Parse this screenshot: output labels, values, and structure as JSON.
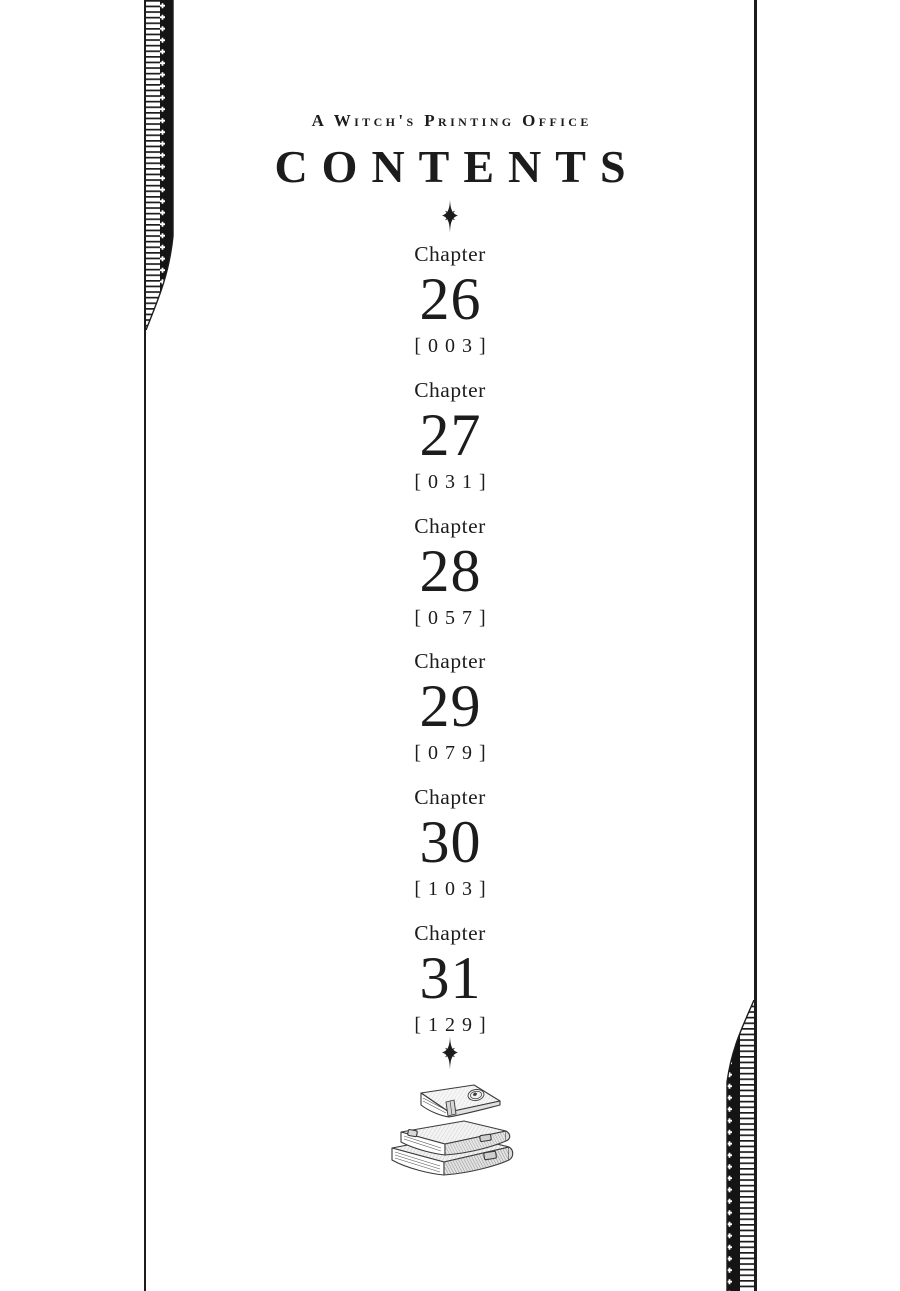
{
  "page": {
    "series_title": "A Witch's Printing Office",
    "title": "CONTENTS"
  },
  "chapters": [
    {
      "label": "Chapter",
      "number": "26",
      "page_display": "[003]"
    },
    {
      "label": "Chapter",
      "number": "27",
      "page_display": "[031]"
    },
    {
      "label": "Chapter",
      "number": "28",
      "page_display": "[057]"
    },
    {
      "label": "Chapter",
      "number": "29",
      "page_display": "[079]"
    },
    {
      "label": "Chapter",
      "number": "30",
      "page_display": "[103]"
    },
    {
      "label": "Chapter",
      "number": "31",
      "page_display": "[129]"
    }
  ],
  "icons": {
    "sparkle_top": "four-point-sparkle",
    "sparkle_bottom": "four-point-sparkle",
    "books": "stacked-antique-books",
    "left_border": "filmstrip-ladder-ornament",
    "right_border": "filmstrip-ladder-ornament"
  },
  "colors": {
    "ink": "#1c1c1c",
    "background": "#ffffff"
  }
}
